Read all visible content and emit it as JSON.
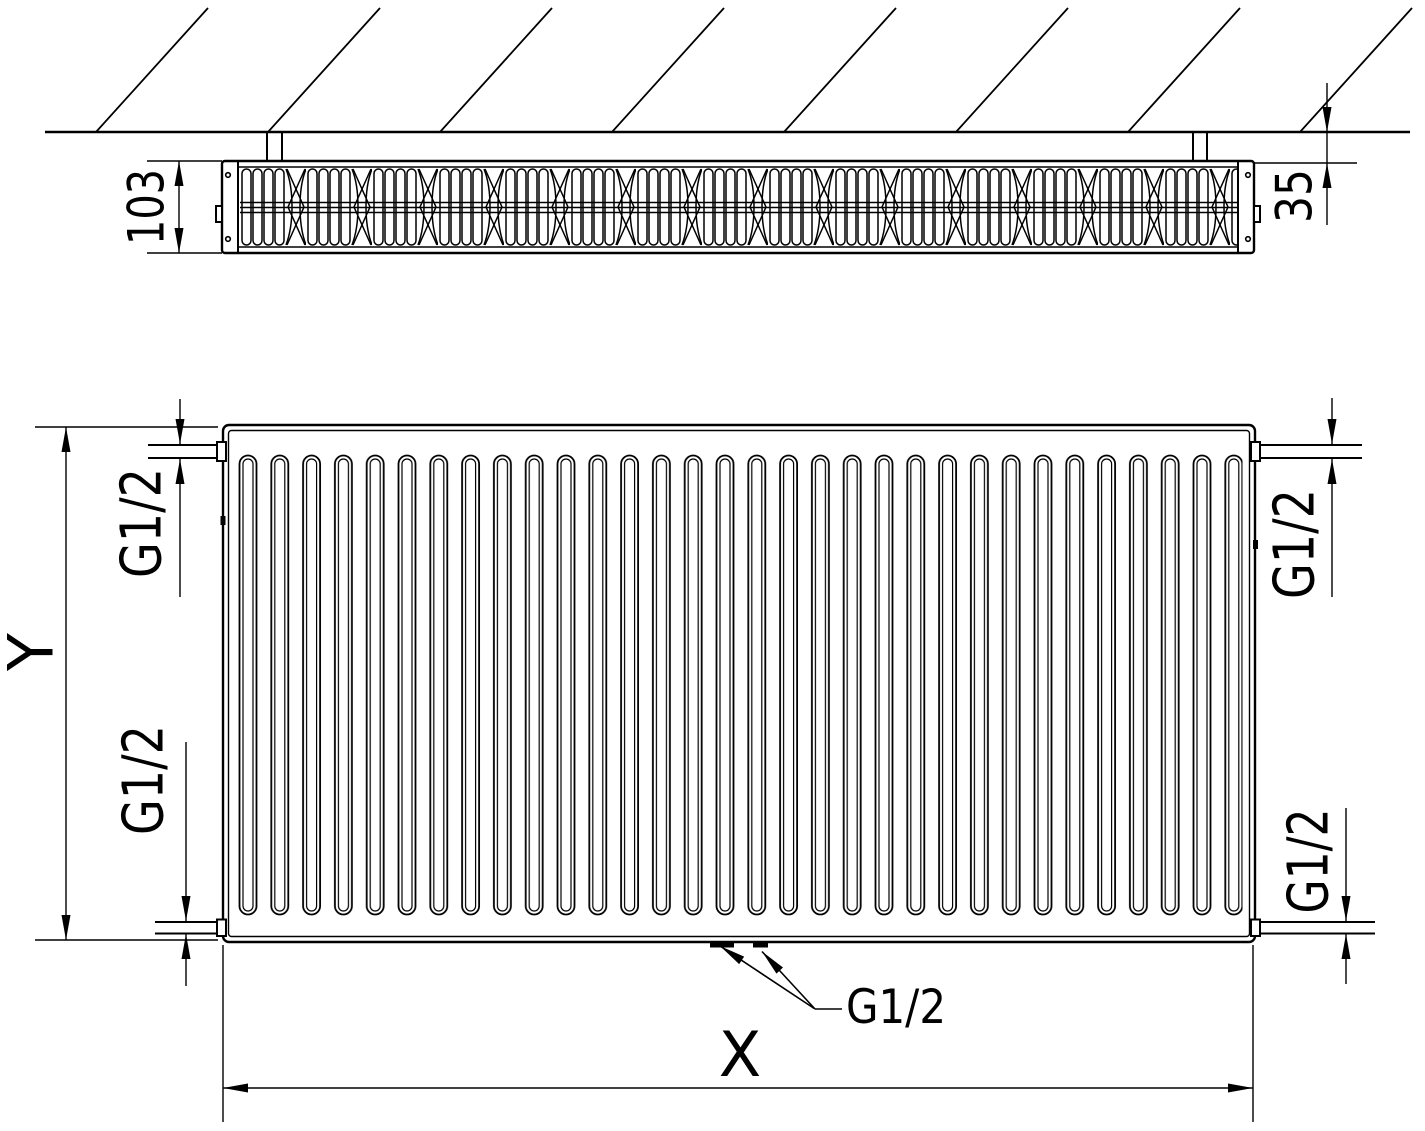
{
  "colors": {
    "background": "#ffffff",
    "line": "#000000",
    "text": "#000000"
  },
  "top_view": {
    "depth_label": "103",
    "wall_clearance_label": "35"
  },
  "front_view": {
    "height_label": "Y",
    "length_label": "X",
    "threads": {
      "top_left": "G1/2",
      "bottom_left": "G1/2",
      "top_right": "G1/2",
      "bottom_right": "G1/2",
      "bottom_center": "G1/2"
    }
  }
}
